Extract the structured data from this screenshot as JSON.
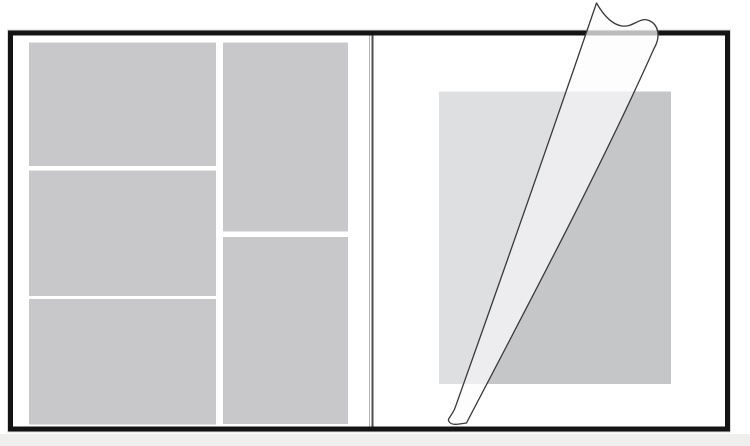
{
  "diagram": {
    "description": "photo-album-spread-with-peeling-protective-film",
    "canvas": {
      "width": 750,
      "height": 446,
      "background": "#ffffff"
    },
    "colors": {
      "page_fill": "#ffffff",
      "frame_stroke": "#141414",
      "frame_halo": "#d9d9d9",
      "photo_slot_fill": "#c8c8ca",
      "right_photo_fill": "#c5c6c8",
      "film_flat_fill": "rgba(255,255,255,0.44)",
      "film_cone_fill": "rgba(252,252,253,0.72)",
      "film_stroke": "#3a3a3a",
      "spine_light": "#b2b2b2",
      "spine_dark": "#4f4f4f",
      "bottom_bar_fill": "#efefee"
    },
    "frame": {
      "x": 10.5,
      "y": 33,
      "width": 717,
      "height": 396,
      "stroke_width": 5
    },
    "bottom_bar": {
      "x": 0,
      "y": 434,
      "width": 750,
      "height": 12
    },
    "spine": {
      "x_light": 369.5,
      "x_dark": 372.5,
      "y1": 35.5,
      "y2": 426.5,
      "light_width": 1,
      "dark_width": 2
    },
    "left_page": {
      "photo_slots": [
        {
          "x": 29,
          "y": 42.5,
          "width": 187,
          "height": 123.5
        },
        {
          "x": 29,
          "y": 170.5,
          "width": 187,
          "height": 125.5
        },
        {
          "x": 29,
          "y": 299,
          "width": 187,
          "height": 125.5
        },
        {
          "x": 223,
          "y": 42.5,
          "width": 125,
          "height": 189
        },
        {
          "x": 223,
          "y": 237,
          "width": 125,
          "height": 187
        }
      ]
    },
    "right_page": {
      "photo": {
        "x": 439,
        "y": 91.5,
        "width": 232,
        "height": 292.5
      },
      "film_flat_points": "439,91.5 565.9,91.5 463.3,384 439,384",
      "film_cone_path": "M 596.5,3 Q 527,206 455,408 C 451.5,416.5 446.8,419 449,421.5 C 450.6,424.6 455.5,424.6 459.5,424 L 466.5,423 C 520,320 600,170 654,48.5 C 661,36.5 658.5,24.5 649,20.5 C 639.5,16.5 633.5,27.6 622,26 C 611,24.4 602.5,13.5 596.5,3 Z",
      "film_stroke_width": 1.3
    }
  }
}
